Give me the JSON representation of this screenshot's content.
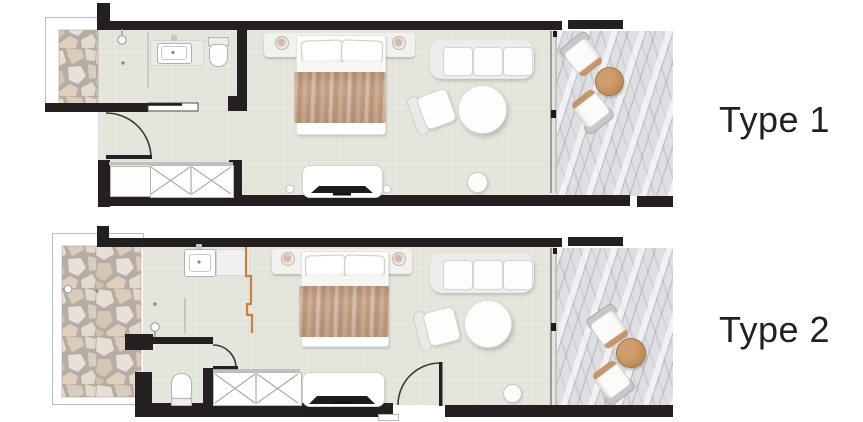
{
  "plans": [
    {
      "id": "type-1",
      "label": "Type 1",
      "areas": [
        "entry-patio",
        "bathroom",
        "bedroom-living",
        "terrace"
      ],
      "furniture": [
        "shower",
        "vanity-sink",
        "toilet",
        "sliding-bathroom-door",
        "entry-door",
        "open-shelf",
        "wardrobe",
        "double-bed",
        "headboard-with-lamps",
        "tv-console",
        "sofa",
        "armchair",
        "round-table",
        "stool",
        "terrace-sliding-door",
        "terrace-chairs",
        "terrace-wood-table"
      ]
    },
    {
      "id": "type-2",
      "label": "Type 2",
      "areas": [
        "entry-patio",
        "open-bathroom",
        "toilet-niche",
        "bedroom-living",
        "terrace"
      ],
      "furniture": [
        "outdoor-tap",
        "vanity-sink",
        "shower-screen",
        "toilet",
        "interior-door",
        "entry-door",
        "wardrobe",
        "double-bed",
        "headboard-with-lamps",
        "tv-console",
        "sofa",
        "armchair",
        "round-table",
        "stool",
        "terrace-sliding-door",
        "terrace-chairs",
        "terrace-wood-table"
      ]
    }
  ],
  "colors": {
    "background": "#ffffff",
    "wall": "#242021",
    "floor": "#e5e6dd",
    "marble": "#dfdfe3",
    "stone": "#d9cec1",
    "grout": "#b3aaa0",
    "blanket": "#c49e80",
    "wood": "#c08a59",
    "screen": "#c8823c",
    "ink": "#231f20"
  }
}
